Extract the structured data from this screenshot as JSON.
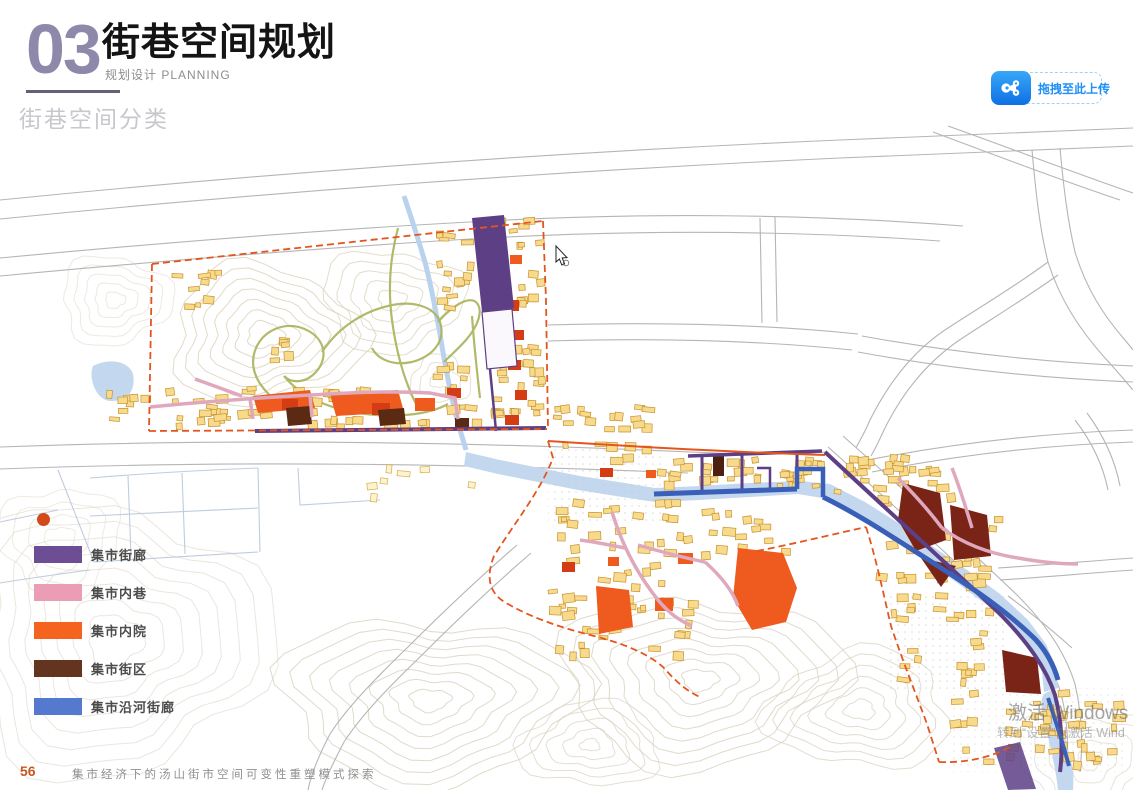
{
  "header": {
    "chapter_number": "03",
    "title": "街巷空间规划",
    "subtitle": "规划设计 PLANNING",
    "section_title": "街巷空间分类"
  },
  "toolbar": {
    "upload_label": "拖拽至此上传",
    "upload_icon": "netdisk-cloud-icon",
    "accent_color": "#1e90f5"
  },
  "legend": {
    "marker_color": "#d2491a",
    "items": [
      {
        "label": "集市街廊",
        "color": "#6d4e94"
      },
      {
        "label": "集市内巷",
        "color": "#eb9db6"
      },
      {
        "label": "集市内院",
        "color": "#f4641e"
      },
      {
        "label": "集市街区",
        "color": "#63341f"
      },
      {
        "label": "集市沿河街廊",
        "color": "#5479ce"
      }
    ]
  },
  "footer": {
    "page_number": "56",
    "caption": "集市经济下的汤山街市空间可变性重塑模式探索"
  },
  "watermark": {
    "line1": "激活 Windows",
    "line2": "转到“设置”以激活 Wind"
  }
}
